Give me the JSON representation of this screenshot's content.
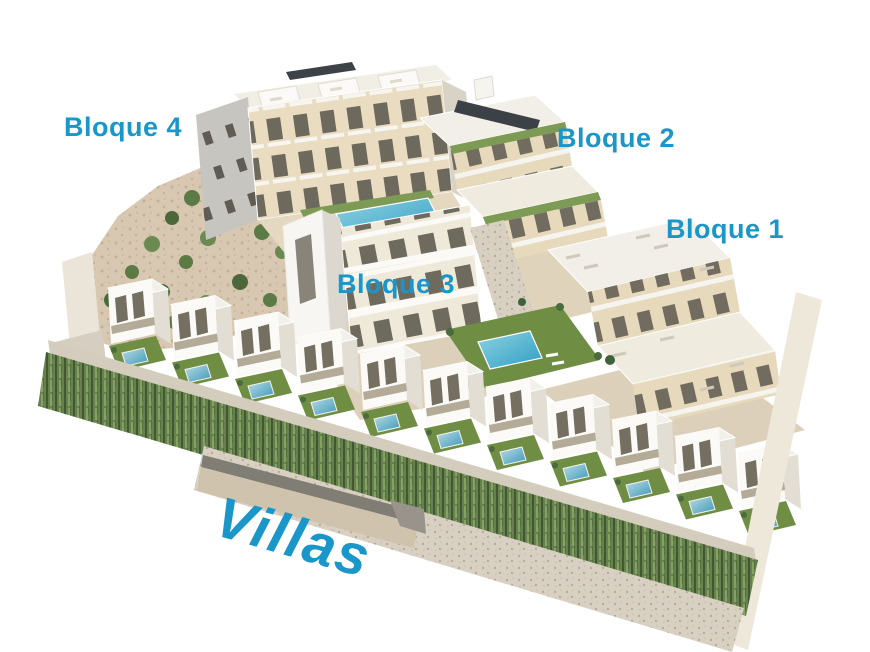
{
  "labels": {
    "bloque4": "Bloque 4",
    "bloque2": "Bloque 2",
    "bloque1": "Bloque 1",
    "bloque3": "Bloque 3",
    "villas": "Villas"
  },
  "colors": {
    "label_blue": "#1b96c8",
    "facade_beige": "#e8dabc",
    "roof_white": "#f2efe8",
    "lawn_green": "#6f8e44",
    "hedge_green": "#66814f",
    "pool_blue": "#53a8c6",
    "terrain_tan": "#d8c8b2",
    "stone_wall": "#d8d0c2"
  }
}
